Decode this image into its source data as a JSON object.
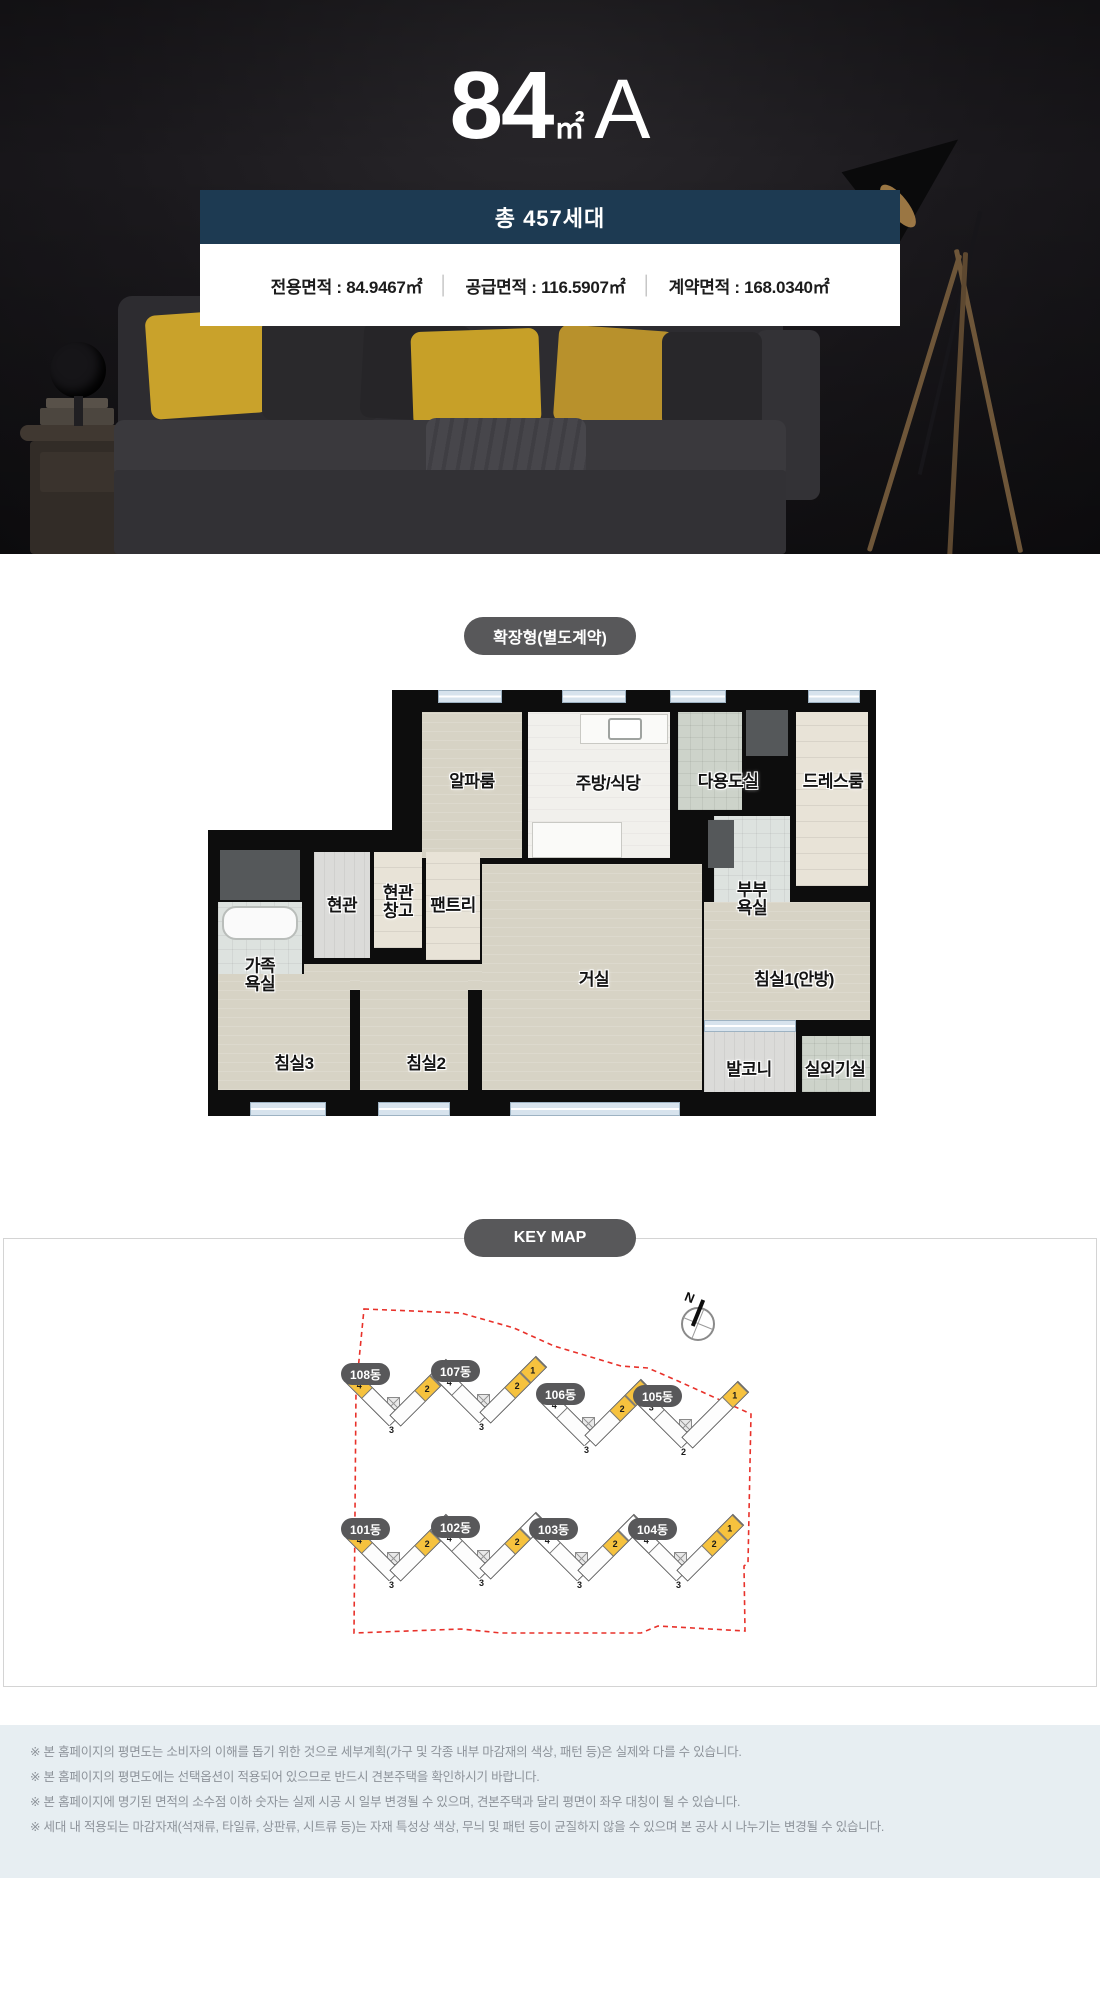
{
  "hero": {
    "title": {
      "size": "84",
      "unit": "㎡",
      "type": "A"
    },
    "badge": "총 457세대",
    "areas": [
      {
        "label": "전용면적",
        "value": "84.9467㎡"
      },
      {
        "label": "공급면적",
        "value": "116.5907㎡"
      },
      {
        "label": "계약면적",
        "value": "168.0340㎡"
      }
    ],
    "separator": "│"
  },
  "floorplan": {
    "badge": "확장형(별도계약)",
    "rooms": [
      {
        "id": "alpha",
        "lines": [
          "알파룸"
        ]
      },
      {
        "id": "kitchen",
        "lines": [
          "주방/식당"
        ]
      },
      {
        "id": "dau",
        "lines": [
          "다용도실"
        ]
      },
      {
        "id": "dress",
        "lines": [
          "드레스룸"
        ]
      },
      {
        "id": "hyeon",
        "lines": [
          "현관"
        ]
      },
      {
        "id": "changgo",
        "lines": [
          "현관",
          "창고"
        ]
      },
      {
        "id": "pantry",
        "lines": [
          "팬트리"
        ]
      },
      {
        "id": "bubu",
        "lines": [
          "부부",
          "욕실"
        ]
      },
      {
        "id": "fambath",
        "lines": [
          "가족",
          "욕실"
        ]
      },
      {
        "id": "living",
        "lines": [
          "거실"
        ]
      },
      {
        "id": "bed1",
        "lines": [
          "침실1(안방)"
        ]
      },
      {
        "id": "bed3",
        "lines": [
          "침실3"
        ]
      },
      {
        "id": "bed2",
        "lines": [
          "침실2"
        ]
      },
      {
        "id": "balcony",
        "lines": [
          "발코니"
        ]
      },
      {
        "id": "outdoor",
        "lines": [
          "실외기실"
        ]
      }
    ]
  },
  "keymap": {
    "title": "KEY MAP",
    "compass_label": "N",
    "buildings": [
      {
        "id": "b108",
        "label": "108동",
        "left": [
          {
            "n": "4",
            "hl": true
          }
        ],
        "right": [
          {
            "n": "2",
            "hl": true
          },
          {
            "n": "1",
            "hl": false
          }
        ],
        "vertex": {
          "n": "3",
          "hl": false
        }
      },
      {
        "id": "b107",
        "label": "107동",
        "left": [
          {
            "n": "4",
            "hl": false
          }
        ],
        "right": [
          {
            "n": "2",
            "hl": true
          },
          {
            "n": "1",
            "hl": true
          }
        ],
        "vertex": {
          "n": "3",
          "hl": false
        }
      },
      {
        "id": "b106",
        "label": "106동",
        "left": [
          {
            "n": "4",
            "hl": false
          }
        ],
        "right": [
          {
            "n": "2",
            "hl": true
          },
          {
            "n": "1",
            "hl": true
          }
        ],
        "vertex": {
          "n": "3",
          "hl": false
        }
      },
      {
        "id": "b105",
        "label": "105동",
        "left": [
          {
            "n": "3",
            "hl": false
          }
        ],
        "right": [
          {
            "n": "1",
            "hl": true
          }
        ],
        "vertex": {
          "n": "2",
          "hl": false
        }
      },
      {
        "id": "b101",
        "label": "101동",
        "left": [
          {
            "n": "4",
            "hl": true
          }
        ],
        "right": [
          {
            "n": "2",
            "hl": true
          },
          {
            "n": "1",
            "hl": false
          }
        ],
        "vertex": {
          "n": "3",
          "hl": false
        }
      },
      {
        "id": "b102",
        "label": "102동",
        "left": [
          {
            "n": "4",
            "hl": false
          }
        ],
        "right": [
          {
            "n": "2",
            "hl": true
          },
          {
            "n": "1",
            "hl": false
          }
        ],
        "vertex": {
          "n": "3",
          "hl": false
        }
      },
      {
        "id": "b103",
        "label": "103동",
        "left": [
          {
            "n": "4",
            "hl": false
          }
        ],
        "right": [
          {
            "n": "2",
            "hl": true
          },
          {
            "n": "1",
            "hl": false
          }
        ],
        "vertex": {
          "n": "3",
          "hl": false
        }
      },
      {
        "id": "b104",
        "label": "104동",
        "left": [
          {
            "n": "4",
            "hl": false
          }
        ],
        "right": [
          {
            "n": "2",
            "hl": true
          },
          {
            "n": "1",
            "hl": true
          }
        ],
        "vertex": {
          "n": "3",
          "hl": false
        }
      }
    ]
  },
  "notes": {
    "items": [
      "※ 본 홈페이지의 평면도는 소비자의 이해를 돕기 위한 것으로 세부계획(가구 및 각종 내부 마감재의 색상, 패턴 등)은 실제와 다를 수 있습니다.",
      "※ 본 홈페이지의 평면도에는 선택옵션이 적용되어 있으므로 반드시 견본주택을 확인하시기 바랍니다.",
      "※ 본 홈페이지에 명기된 면적의 소수점 이하 숫자는 실제 시공 시 일부 변경될 수 있으며, 견본주택과 달리 평면이 좌우 대칭이 될 수 있습니다.",
      "※ 세대 내 적용되는 마감자재(석재류, 타일류, 상판류, 시트류 등)는 자재 특성상 색상, 무늬 및 패턴 등이 균질하지 않을 수 있으며 본 공사 시 나누기는 변경될 수 있습니다."
    ]
  },
  "colors": {
    "accent_navy": "#1d3a52",
    "unit_highlight_yellow": "#f6c23e",
    "boundary_red": "#e8312a",
    "pillow_yellow": "#c9a22b"
  }
}
